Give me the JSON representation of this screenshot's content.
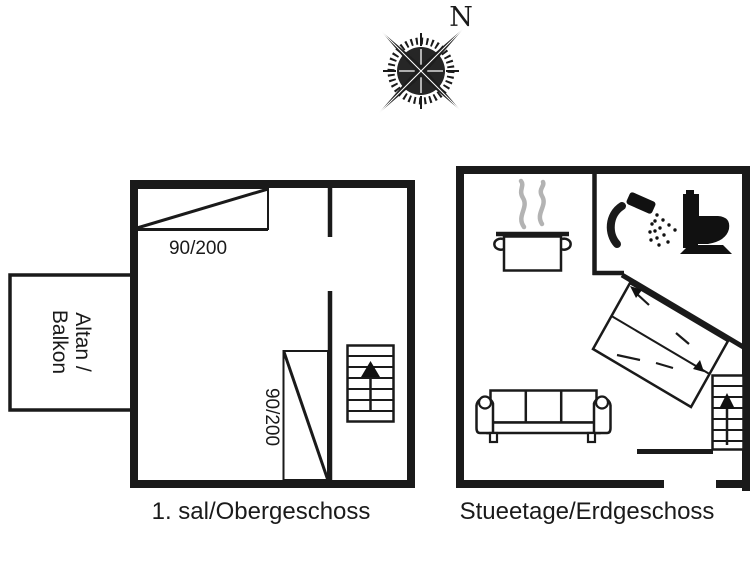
{
  "page": {
    "background_color": "#ffffff",
    "line_color": "#1a1a1a",
    "icon_fill_color": "#111111",
    "steam_color": "#b3b3b3"
  },
  "compass": {
    "icon": "compass-rose-icon",
    "north_label": "N"
  },
  "upper_floor": {
    "caption": "1. sal/Obergeschoss",
    "balcony": {
      "label_line1": "Altan /",
      "label_line2": "Balkon"
    },
    "doors": [
      {
        "size": "90/200",
        "wall": "top"
      },
      {
        "size": "90/200",
        "wall": "interior-vertical"
      }
    ],
    "icons": [
      "stairs-up-icon"
    ]
  },
  "ground_floor": {
    "caption": "Stueetage/Erdgeschoss",
    "icons": [
      "cooking-pot-icon",
      "steam-icon",
      "shower-icon",
      "toilet-icon",
      "double-bed-icon",
      "sofa-icon",
      "stairs-up-icon"
    ]
  }
}
